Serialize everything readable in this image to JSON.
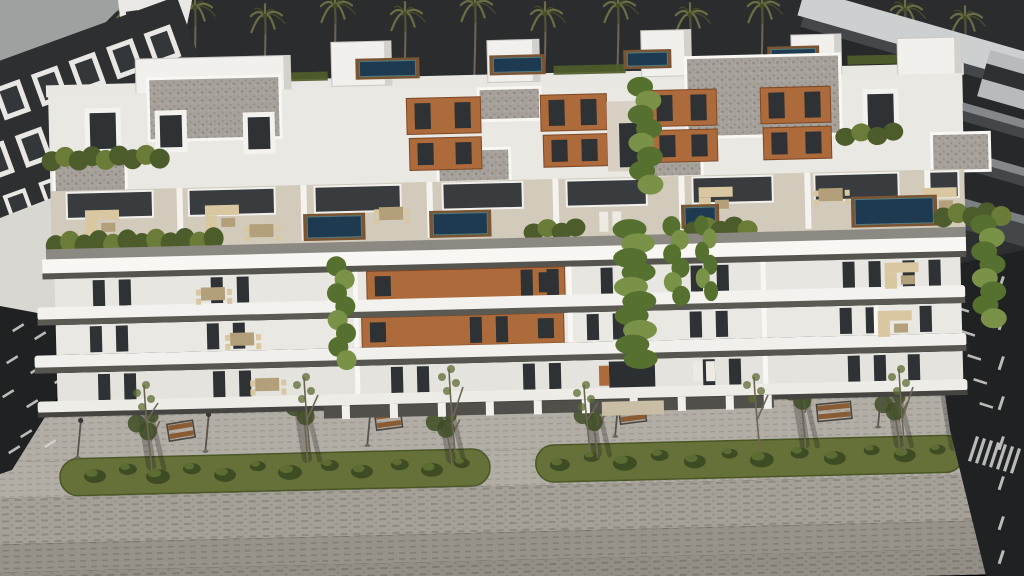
{
  "scene": {
    "description": "Aerial dusk 3D architectural rendering of a modern white apartment complex with rooftop pools, duplex penthouses, planted terraces, cascading vines, and a paved boulevard with two landscaped median strips, benches and street lamps; dark neighbouring buildings and a row of palm trees against a dark sky.",
    "time_of_day": "dusk",
    "colors": {
      "sky": "#2b2c2e",
      "white_sunlit": "#f3f2ee",
      "white_bright": "#f8f7f3",
      "white_shade": "#e7e6e1",
      "slab_shadow": "#56554f",
      "fascia": "#8b8982",
      "timber": "#ad6b3c",
      "window_dark": "#2e3234",
      "gravel_base": "#a6a29b",
      "terrace_floor": "#d2cabb",
      "furniture": "#d8c7a1",
      "furniture_dark": "#b3a07a",
      "pool_water": "#1e3a50",
      "pool_edge": "#4f7b80",
      "pool_deck": "#7a5534",
      "hedge": "#4c5c2a",
      "hedge_light": "#6b7c39",
      "vine": "#55702f",
      "vine_light": "#7a9247",
      "grass": "#66713a",
      "bush": "#3e4c24",
      "bush_light": "#5c6c33",
      "dry_canopy": "#837c60",
      "sidewalk": "#b2aea6",
      "pavement": "#a5a198",
      "pavement_dash": "#8d897f",
      "pavement_low": "#97928a",
      "road": "#1f2123",
      "road_marking": "#d6d5d1",
      "dark_building": "#2e2f31",
      "dark_building_frame": "#e8e7e3",
      "right_building_face": "#44474a",
      "right_building_band": "#26282a",
      "right_building_slab": "#85888a",
      "trunk": "#6e6655",
      "frond": "#6e7144",
      "frond_dark": "#474b2a",
      "bench_wood": "#8a5c33",
      "shadow": "#141412",
      "car_body": "#232528"
    },
    "palms": [
      {
        "x": 125,
        "top": 14,
        "h": 120
      },
      {
        "x": 195,
        "top": 8,
        "h": 130
      },
      {
        "x": 265,
        "top": 16,
        "h": 118
      },
      {
        "x": 335,
        "top": 6,
        "h": 132
      },
      {
        "x": 405,
        "top": 14,
        "h": 122
      },
      {
        "x": 475,
        "top": 5,
        "h": 134
      },
      {
        "x": 545,
        "top": 14,
        "h": 120
      },
      {
        "x": 618,
        "top": 6,
        "h": 130
      },
      {
        "x": 690,
        "top": 15,
        "h": 118
      },
      {
        "x": 762,
        "top": 6,
        "h": 128
      },
      {
        "x": 832,
        "top": 16,
        "h": 110
      },
      {
        "x": 905,
        "top": 10,
        "h": 100
      },
      {
        "x": 965,
        "top": 18,
        "h": 90
      }
    ],
    "rooftop_pools": [
      {
        "x": 364,
        "y": 58,
        "w": 56,
        "h": 15
      },
      {
        "x": 498,
        "y": 58,
        "w": 48,
        "h": 14
      },
      {
        "x": 632,
        "y": 56,
        "w": 40,
        "h": 13
      },
      {
        "x": 776,
        "y": 56,
        "w": 44,
        "h": 13
      }
    ],
    "terrace_pools": [
      {
        "x": 308,
        "y": 212,
        "w": 54,
        "h": 21
      },
      {
        "x": 434,
        "y": 212,
        "w": 54,
        "h": 21
      },
      {
        "x": 686,
        "y": 212,
        "w": 30,
        "h": 18
      },
      {
        "x": 856,
        "y": 208,
        "w": 78,
        "h": 25
      }
    ],
    "gravel_roofs": [
      {
        "x": 152,
        "y": 70,
        "w": 132,
        "h": 62
      },
      {
        "x": 690,
        "y": 62,
        "w": 154,
        "h": 80
      },
      {
        "x": 482,
        "y": 88,
        "w": 62,
        "h": 32
      },
      {
        "x": 440,
        "y": 148,
        "w": 72,
        "h": 33
      },
      {
        "x": 640,
        "y": 148,
        "w": 64,
        "h": 33
      },
      {
        "x": 56,
        "y": 146,
        "w": 72,
        "h": 37
      },
      {
        "x": 934,
        "y": 144,
        "w": 58,
        "h": 38
      }
    ],
    "green_roof_strips": [
      {
        "x": 215,
        "y": 67,
        "w": 117,
        "h": 9
      },
      {
        "x": 558,
        "y": 67,
        "w": 72,
        "h": 9
      },
      {
        "x": 714,
        "y": 65,
        "w": 62,
        "h": 9
      },
      {
        "x": 852,
        "y": 64,
        "w": 76,
        "h": 9
      }
    ],
    "penthouse_boxes": [
      {
        "x": 336,
        "y": 38,
        "w": 60,
        "h": 44
      },
      {
        "x": 492,
        "y": 40,
        "w": 52,
        "h": 42
      },
      {
        "x": 646,
        "y": 34,
        "w": 50,
        "h": 46
      },
      {
        "x": 796,
        "y": 42,
        "w": 50,
        "h": 40
      },
      {
        "x": 140,
        "y": 50,
        "w": 155,
        "h": 46
      },
      {
        "x": 902,
        "y": 48,
        "w": 64,
        "h": 66
      }
    ],
    "timber_panels": [
      {
        "x": 410,
        "y": 96,
        "w": 74,
        "h": 36
      },
      {
        "x": 544,
        "y": 96,
        "w": 66,
        "h": 36
      },
      {
        "x": 652,
        "y": 94,
        "w": 68,
        "h": 36
      },
      {
        "x": 764,
        "y": 94,
        "w": 70,
        "h": 36
      },
      {
        "x": 412,
        "y": 136,
        "w": 72,
        "h": 32
      },
      {
        "x": 546,
        "y": 136,
        "w": 64,
        "h": 32
      },
      {
        "x": 654,
        "y": 134,
        "w": 66,
        "h": 32
      },
      {
        "x": 766,
        "y": 134,
        "w": 68,
        "h": 32
      },
      {
        "x": 366,
        "y": 268,
        "w": 198,
        "h": 30
      },
      {
        "x": 360,
        "y": 314,
        "w": 202,
        "h": 30
      }
    ],
    "upper_window_frames": [
      {
        "x": 88,
        "y": 98,
        "w": 36,
        "h": 46
      },
      {
        "x": 158,
        "y": 102,
        "w": 32,
        "h": 42
      },
      {
        "x": 246,
        "y": 106,
        "w": 32,
        "h": 42
      },
      {
        "x": 866,
        "y": 98,
        "w": 36,
        "h": 46
      }
    ],
    "floor_windows": [
      {
        "y": 270,
        "h": 26,
        "xs": [
          92,
          118,
          210,
          236,
          520,
          546,
          600,
          626,
          690,
          716,
          842,
          868,
          902,
          928
        ]
      },
      {
        "y": 316,
        "h": 26,
        "xs": [
          88,
          114,
          205,
          231,
          468,
          494,
          585,
          611,
          688,
          714,
          838,
          864,
          918
        ]
      },
      {
        "y": 364,
        "h": 26,
        "xs": [
          95,
          121,
          210,
          236,
          388,
          414,
          520,
          546,
          700,
          726,
          845,
          871,
          905
        ]
      }
    ],
    "balcony_fins": [
      {
        "x": 352,
        "y": 268,
        "h": 30
      },
      {
        "x": 566,
        "y": 268,
        "h": 30
      },
      {
        "x": 760,
        "y": 268,
        "h": 30
      },
      {
        "x": 352,
        "y": 314,
        "h": 30
      },
      {
        "x": 566,
        "y": 314,
        "h": 30
      },
      {
        "x": 760,
        "y": 314,
        "h": 30
      },
      {
        "x": 872,
        "y": 314,
        "h": 30
      },
      {
        "x": 352,
        "y": 362,
        "h": 30
      },
      {
        "x": 760,
        "y": 362,
        "h": 30
      }
    ],
    "terrace_glass": [
      {
        "x": 68,
        "w": 86
      },
      {
        "x": 190,
        "w": 86
      },
      {
        "x": 316,
        "w": 86
      },
      {
        "x": 444,
        "w": 80
      },
      {
        "x": 568,
        "w": 80
      },
      {
        "x": 694,
        "w": 80
      },
      {
        "x": 816,
        "w": 84
      },
      {
        "x": 930,
        "w": 30
      }
    ],
    "terrace_dividers": [
      178,
      302,
      428,
      554,
      680,
      806,
      926
    ],
    "furniture": [
      {
        "t": "sofa",
        "x": 86,
        "y": 200
      },
      {
        "t": "sofa",
        "x": 206,
        "y": 198
      },
      {
        "t": "dining",
        "x": 380,
        "y": 200
      },
      {
        "t": "lounger",
        "x": 600,
        "y": 214
      },
      {
        "t": "sofa",
        "x": 700,
        "y": 192
      },
      {
        "t": "dining",
        "x": 820,
        "y": 192
      },
      {
        "t": "sofa",
        "x": 924,
        "y": 198
      },
      {
        "t": "dining",
        "x": 250,
        "y": 214
      },
      {
        "t": "dining",
        "x": 200,
        "y": 276
      },
      {
        "t": "sofa",
        "x": 884,
        "y": 272
      },
      {
        "t": "dining",
        "x": 228,
        "y": 322
      },
      {
        "t": "sofa",
        "x": 876,
        "y": 320
      },
      {
        "t": "dining",
        "x": 252,
        "y": 368
      },
      {
        "t": "lounger",
        "x": 690,
        "y": 366
      }
    ],
    "hedges": [
      {
        "x1": 54,
        "x2": 162,
        "y": 140,
        "h": 16
      },
      {
        "x1": 848,
        "x2": 896,
        "y": 136,
        "h": 14
      },
      {
        "x1": 56,
        "x2": 214,
        "y": 224,
        "h": 18
      },
      {
        "x1": 534,
        "x2": 576,
        "y": 224,
        "h": 14
      },
      {
        "x1": 694,
        "x2": 748,
        "y": 226,
        "h": 14
      },
      {
        "x1": 944,
        "x2": 1002,
        "y": 218,
        "h": 16
      }
    ],
    "vines": [
      {
        "x": 648,
        "y1": 90,
        "y2": 188,
        "w": 26
      },
      {
        "x": 340,
        "y1": 262,
        "y2": 356,
        "w": 20
      },
      {
        "x": 634,
        "y1": 232,
        "y2": 362,
        "w": 34
      },
      {
        "x": 676,
        "y1": 230,
        "y2": 300,
        "w": 18
      },
      {
        "x": 706,
        "y1": 230,
        "y2": 296,
        "w": 14
      },
      {
        "x": 988,
        "y1": 236,
        "y2": 330,
        "w": 26
      }
    ],
    "median_bushes": [
      {
        "x": 95,
        "y": 466,
        "r": 11
      },
      {
        "x": 128,
        "y": 460,
        "r": 9
      },
      {
        "x": 158,
        "y": 468,
        "r": 12
      },
      {
        "x": 192,
        "y": 461,
        "r": 9
      },
      {
        "x": 225,
        "y": 468,
        "r": 11
      },
      {
        "x": 258,
        "y": 460,
        "r": 8
      },
      {
        "x": 290,
        "y": 467,
        "r": 12
      },
      {
        "x": 330,
        "y": 461,
        "r": 9
      },
      {
        "x": 362,
        "y": 468,
        "r": 11
      },
      {
        "x": 400,
        "y": 462,
        "r": 9
      },
      {
        "x": 432,
        "y": 468,
        "r": 11
      },
      {
        "x": 462,
        "y": 462,
        "r": 8
      },
      {
        "x": 560,
        "y": 466,
        "r": 10
      },
      {
        "x": 592,
        "y": 459,
        "r": 8
      },
      {
        "x": 625,
        "y": 466,
        "r": 12
      },
      {
        "x": 660,
        "y": 459,
        "r": 9
      },
      {
        "x": 695,
        "y": 466,
        "r": 11
      },
      {
        "x": 730,
        "y": 459,
        "r": 8
      },
      {
        "x": 762,
        "y": 466,
        "r": 12
      },
      {
        "x": 800,
        "y": 460,
        "r": 9
      },
      {
        "x": 835,
        "y": 466,
        "r": 11
      },
      {
        "x": 872,
        "y": 459,
        "r": 8
      },
      {
        "x": 905,
        "y": 465,
        "r": 11
      },
      {
        "x": 938,
        "y": 460,
        "r": 8
      }
    ],
    "median_trees": [
      {
        "x": 152,
        "base": 462,
        "h": 66,
        "lean": -6
      },
      {
        "x": 308,
        "base": 458,
        "h": 78,
        "lean": -4
      },
      {
        "x": 452,
        "base": 462,
        "h": 58,
        "lean": -8
      },
      {
        "x": 598,
        "base": 460,
        "h": 60,
        "lean": -6
      },
      {
        "x": 806,
        "base": 456,
        "h": 80,
        "lean": -5
      },
      {
        "x": 900,
        "base": 458,
        "h": 62,
        "lean": -7
      },
      {
        "x": 955,
        "base": 462,
        "h": 55,
        "lean": 10,
        "dry": true
      }
    ],
    "benches": [
      {
        "x": 168,
        "y": 416,
        "r": -8
      },
      {
        "x": 376,
        "y": 410,
        "r": -6
      },
      {
        "x": 620,
        "y": 410,
        "r": -6
      },
      {
        "x": 818,
        "y": 412,
        "r": -4,
        "wide": true
      }
    ],
    "lamps": [
      {
        "x": 78,
        "y": 446
      },
      {
        "x": 206,
        "y": 443
      },
      {
        "x": 368,
        "y": 441
      },
      {
        "x": 616,
        "y": 438
      },
      {
        "x": 879,
        "y": 435
      }
    ],
    "left_road_dashes": [
      {
        "x": 12,
        "y": 330
      },
      {
        "x": 34,
        "y": 338
      },
      {
        "x": 58,
        "y": 346
      },
      {
        "x": 6,
        "y": 362
      },
      {
        "x": 30,
        "y": 372
      },
      {
        "x": 54,
        "y": 382
      },
      {
        "x": 2,
        "y": 396
      },
      {
        "x": 26,
        "y": 406
      },
      {
        "x": 50,
        "y": 416
      },
      {
        "x": 20,
        "y": 436
      },
      {
        "x": 44,
        "y": 446
      },
      {
        "x": 8,
        "y": 452
      }
    ],
    "right_road_lane_dashes": [
      276,
      316,
      356,
      396,
      436,
      476,
      516,
      550
    ],
    "right_road_ticks": [
      {
        "x": 956,
        "y": 306
      },
      {
        "x": 962,
        "y": 330
      },
      {
        "x": 968,
        "y": 354
      },
      {
        "x": 974,
        "y": 378
      },
      {
        "x": 980,
        "y": 402
      }
    ],
    "crosswalk_bars": [
      {
        "x": 976,
        "y": 436
      },
      {
        "x": 983,
        "y": 438
      },
      {
        "x": 990,
        "y": 440
      },
      {
        "x": 997,
        "y": 442
      },
      {
        "x": 1004,
        "y": 444
      },
      {
        "x": 1011,
        "y": 446
      },
      {
        "x": 1018,
        "y": 448
      }
    ],
    "car": {
      "x": 944,
      "y": 338,
      "rot": 16
    }
  }
}
